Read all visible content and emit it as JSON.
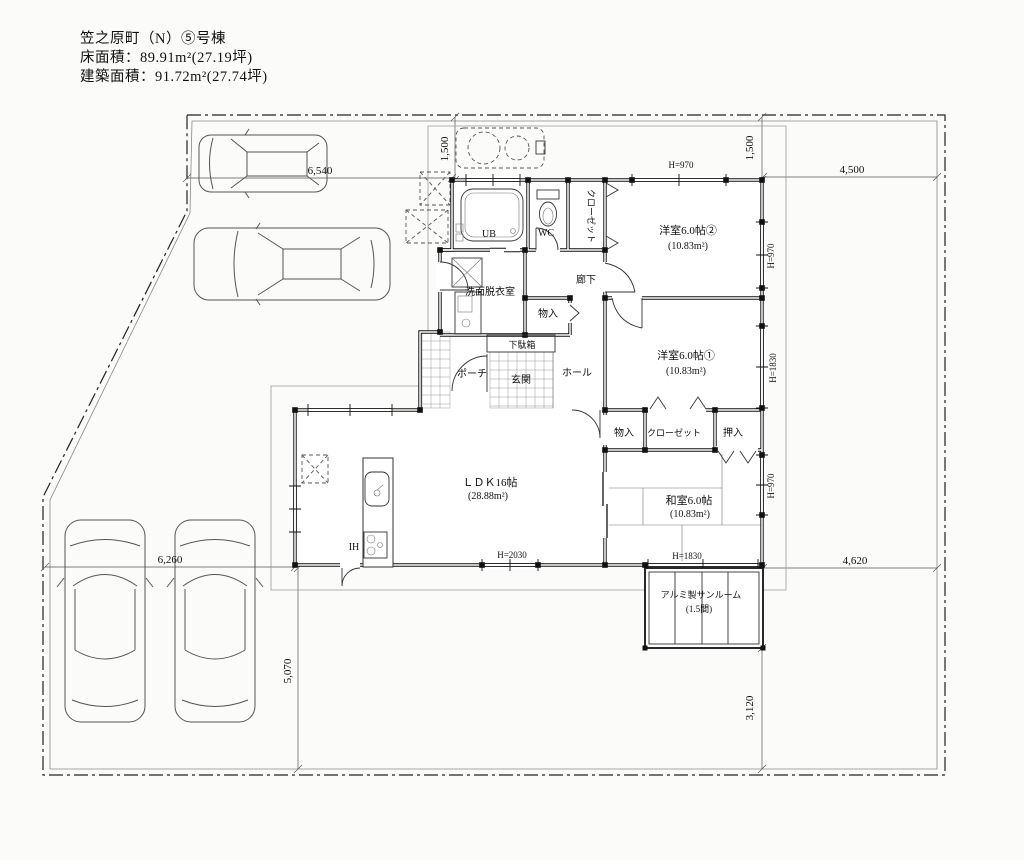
{
  "header": {
    "title": "笠之原町（N）⑤号棟",
    "floor_area": "床面積：89.91m²(27.19坪)",
    "building_area": "建築面積：91.72m²(27.74坪)"
  },
  "rooms": {
    "ub": "UB",
    "wc": "WC",
    "closet_north": "クローゼット",
    "western2": "洋室6.0帖②",
    "western2_area": "(10.83m²)",
    "washroom": "洗面脱衣室",
    "corridor": "廊下",
    "storage_north": "物入",
    "shoe_cabinet": "下駄箱",
    "hall": "ホール",
    "entrance": "玄関",
    "porch": "ポーチ",
    "western1": "洋室6.0帖①",
    "western1_area": "(10.83m²)",
    "storage_south": "物入",
    "closet_south": "クローゼット",
    "oshiire": "押入",
    "japanese": "和室6.0帖",
    "japanese_area": "(10.83m²)",
    "ldk": "ＬＤＫ16帖",
    "ldk_area": "(28.88m²)",
    "ih": "IH",
    "sunroom": "アルミ製サンルーム",
    "sunroom_size": "(1.5間)"
  },
  "dimensions": {
    "site_top_left": "6,540",
    "site_top_right": "4,500",
    "offset_left": "1,500",
    "offset_right": "1,500",
    "site_bottom_left": "6,260",
    "site_left_lower": "5,070",
    "site_bottom_right": "4,620",
    "site_right_lower": "3,120",
    "win_west2_top": "H=970",
    "win_west2_right": "H=970",
    "win_west1_right": "H=1830",
    "win_japanese_right": "H=970",
    "win_ldk_bottom": "H=2030",
    "win_japanese_bottom": "H=1830"
  }
}
